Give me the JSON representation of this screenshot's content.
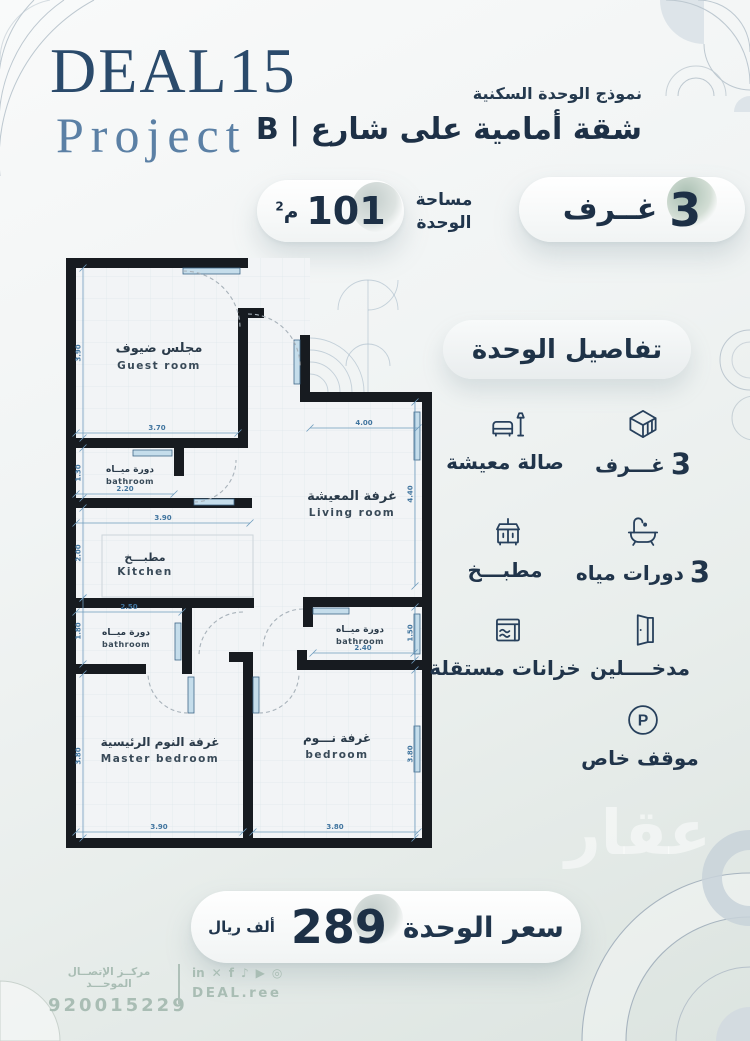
{
  "brand": {
    "name": "DEAL15",
    "subtitle": "Project"
  },
  "header": {
    "kicker": "نموذج الوحدة السكنية",
    "title": "شقة أمامية على شارع | B"
  },
  "badges": {
    "rooms_value": "3",
    "rooms_label": "غــرف",
    "area_label_1": "مساحة",
    "area_label_2": "الوحدة",
    "area_value": "101",
    "area_unit": "م",
    "area_unit_sup": "2"
  },
  "plan": {
    "rooms": [
      {
        "ar": "مجلس ضيوف",
        "en": "Guest room"
      },
      {
        "ar": "دورة ميــاه",
        "en": "bathroom"
      },
      {
        "ar": "مطبـــخ",
        "en": "Kitchen"
      },
      {
        "ar": "غرفة المعيشة",
        "en": "Living room"
      },
      {
        "ar": "دورة ميــاه",
        "en": "bathroom"
      },
      {
        "ar": "دورة ميــاه",
        "en": "bathroom"
      },
      {
        "ar": "غرفة النوم الرئيسية",
        "en": "Master bedroom"
      },
      {
        "ar": "غرفة نـــوم",
        "en": "bedroom"
      }
    ],
    "dims": {
      "guest_w": "3.70",
      "guest_h": "3.90",
      "bath1_w": "2.20",
      "bath1_h": "1.30",
      "kitchen_w": "3.90",
      "kitchen_h": "2.00",
      "living_w": "4.00",
      "living_h": "4.40",
      "bath2_w": "2.50",
      "bath2_h": "1.80",
      "bath3_w": "2.40",
      "bath3_h": "1.50",
      "master_w": "3.90",
      "master_h": "3.80",
      "bedroom_w": "3.80",
      "bedroom_h": "3.80"
    }
  },
  "details": {
    "title": "تفاصيل الوحدة",
    "parking_letter": "P",
    "features": [
      {
        "name": "rooms",
        "num": "3",
        "label": "غـــرف"
      },
      {
        "name": "living-hall",
        "num": "",
        "label": "صالة معيشة"
      },
      {
        "name": "bathrooms",
        "num": "3",
        "label": "دورات مياه"
      },
      {
        "name": "kitchen",
        "num": "",
        "label": "مطبـــخ"
      },
      {
        "name": "entrances",
        "num": "",
        "label": "مدخــــلين"
      },
      {
        "name": "tanks",
        "num": "",
        "label": "خزانات مستقلة"
      },
      {
        "name": "parking",
        "num": "",
        "label": "موقف خاص"
      }
    ]
  },
  "price": {
    "label": "سعر الوحدة",
    "value": "289",
    "unit": "ألف ريال"
  },
  "watermark": {
    "text": "عقار"
  },
  "footer": {
    "call_center_label": "مركــز الإتصــال الموحـــد",
    "phone": "920015229",
    "site": "DEAL.ree",
    "social": [
      "in",
      "✕",
      "f",
      "♪",
      "▶",
      "◎"
    ]
  },
  "colors": {
    "navy": "#1e3248",
    "steel": "#5b80a5",
    "plan_wall": "#171b20",
    "window_blue": "#c5ddeb",
    "dim_blue": "#41759f",
    "footer_text": "#a9bdb4",
    "accent_circle": "#cdd5d3"
  }
}
